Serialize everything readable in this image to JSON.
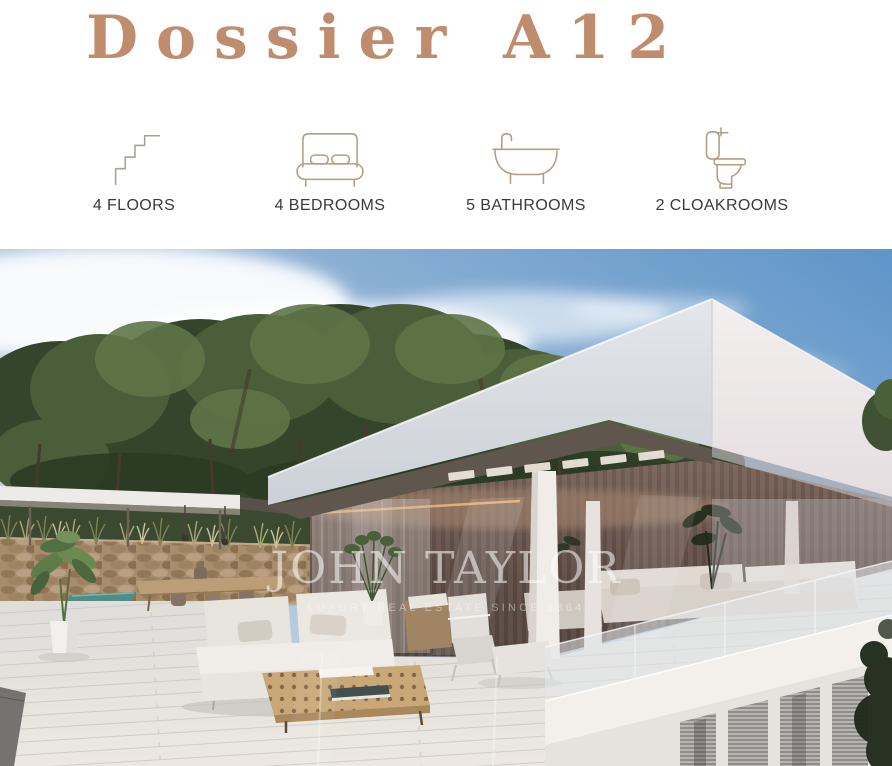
{
  "header": {
    "title": "Dossier A12"
  },
  "features": [
    {
      "icon": "stairs-icon",
      "label": "4 FLOORS"
    },
    {
      "icon": "bed-icon",
      "label": "4 BEDROOMS"
    },
    {
      "icon": "bath-icon",
      "label": "5 BATHROOMS"
    },
    {
      "icon": "toilet-icon",
      "label": "2 CLOAKROOMS"
    }
  ],
  "photo": {
    "watermark": {
      "brand": "JOHN TAYLOR",
      "tagline": "LUXURY REAL ESTATE SINCE 1864"
    }
  },
  "theme": {
    "accent": "#bf8d6d",
    "icon_stroke": "#b59c80",
    "label_color": "#3a3a3a"
  }
}
